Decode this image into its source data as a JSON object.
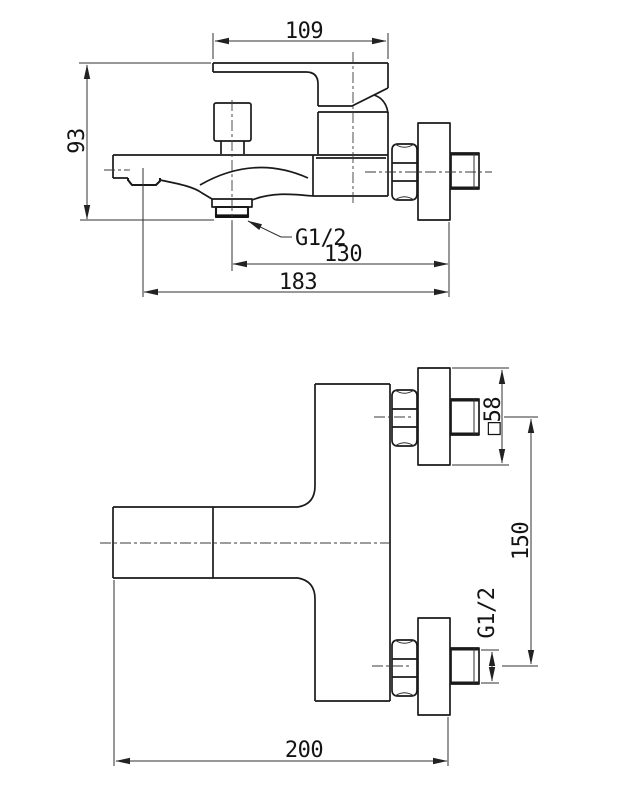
{
  "title": "Wall-mounted bath mixer faucet — dimensional technical drawing",
  "colors": {
    "background": "#ffffff",
    "line": "#1a1a1a",
    "dimension": "#303030"
  },
  "side_view": {
    "name": "side elevation",
    "dims": {
      "handle_length": "109",
      "height": "93",
      "outlet_thread": "G1/2",
      "outlet_to_wall": "130",
      "total_length": "183"
    }
  },
  "plan_view": {
    "name": "plan view",
    "dims": {
      "flange_size": "□58",
      "inlet_spacing": "150",
      "inlet_thread": "G1/2",
      "total_length": "200"
    }
  }
}
